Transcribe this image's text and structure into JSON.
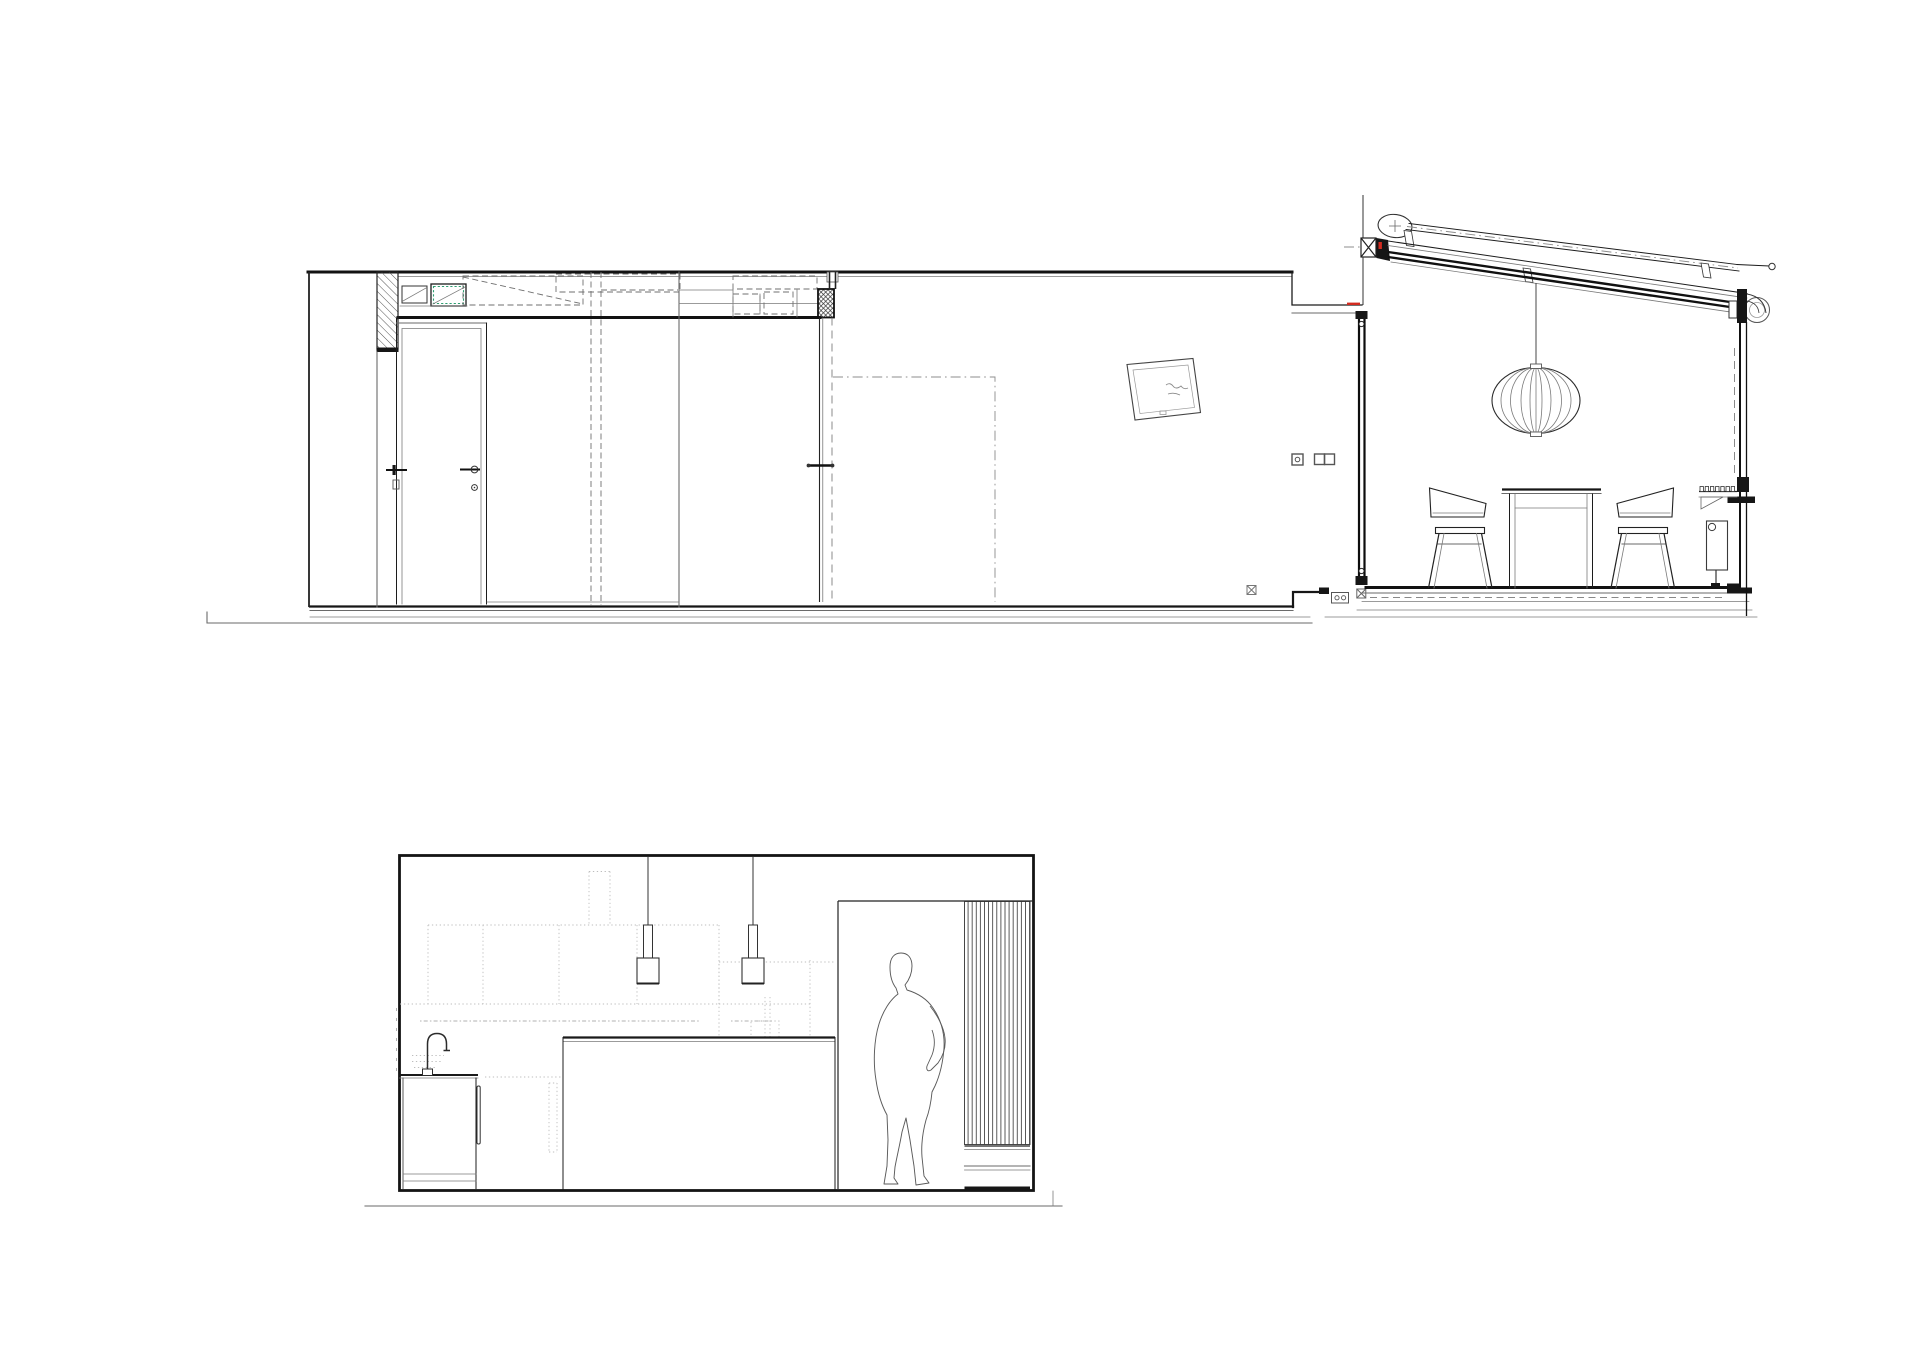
{
  "page": {
    "background": "#ffffff",
    "kind": "architectural drawing sheet",
    "visible_text": "none"
  },
  "views": {
    "section": {
      "label": "Longitudinal section — house with rear dining extension",
      "elements": [
        "ground-line",
        "flat-roof-slab",
        "ceiling-void-ducts",
        "hatched-wall",
        "interior-door",
        "pivot-door",
        "projected-opening-dashdot",
        "leaning-picture-frame",
        "wall-socket",
        "double-light-switch",
        "floor-level-marker",
        "floor-step",
        "floor-outlet-box",
        "glazed-mullion",
        "mono-pitch-roof",
        "rolled-awning",
        "awning-rail",
        "roof-roller-box",
        "pendant-lantern-lamp",
        "dining-table",
        "dining-chair-left",
        "dining-chair-right",
        "radiator",
        "bracket-shelf",
        "full-height-glazing",
        "insulation-marker"
      ]
    },
    "elevation": {
      "label": "Kitchen elevation",
      "elements": [
        "border-frame",
        "pendant-lamp-left",
        "pendant-lamp-right",
        "dotted-tall-cabinets",
        "dotted-extractor-duct",
        "utensil-rail-dotted",
        "kitchen-island",
        "sink-base-cabinet",
        "gooseneck-faucet",
        "passage-opening",
        "vertical-slat-screen",
        "slat-bench",
        "person-silhouette",
        "ground-line"
      ]
    }
  },
  "annotations": {
    "picture_frame_text": "(illegible scribble)"
  },
  "colors": {
    "line": "#1c1c1c",
    "light_line": "#7a7a7a",
    "dotted_line": "#bdbdbd",
    "accent_green": "#2f9e72",
    "accent_red": "#d22b1f",
    "paper": "#ffffff"
  }
}
